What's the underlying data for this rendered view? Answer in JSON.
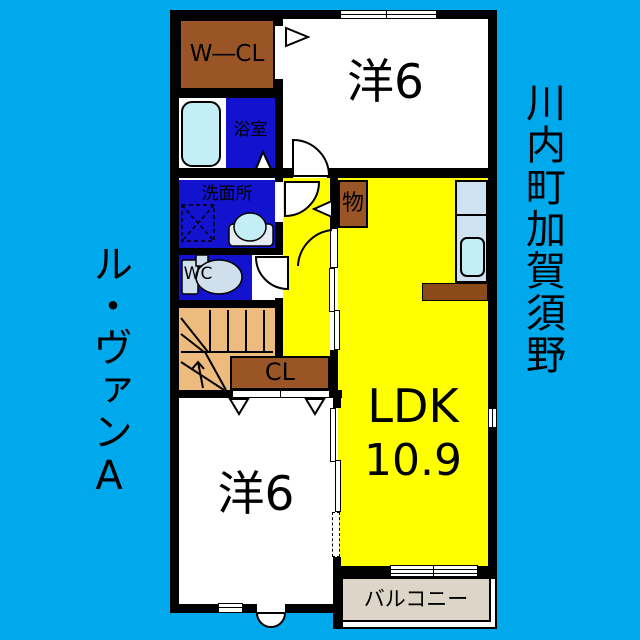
{
  "titles": {
    "left_vertical": "ル・ヴァンA",
    "right_vertical": "川内町加賀須野"
  },
  "rooms": {
    "wcl": {
      "label": "W―CL"
    },
    "bath": {
      "label": "浴室"
    },
    "washroom": {
      "label": "洗面所"
    },
    "wc": {
      "label": "WC"
    },
    "storage": {
      "label": "物"
    },
    "closet": {
      "label": "CL"
    },
    "western_top": {
      "label": "洋6"
    },
    "western_bottom": {
      "label": "洋6"
    },
    "ldk": {
      "label": "LDK",
      "size": "10.9"
    },
    "balcony": {
      "label": "バルコニー"
    }
  },
  "colors": {
    "background": "#00a8ec",
    "wall": "#000000",
    "room_blue": "#1212cf",
    "brown": "#9a5526",
    "counter_brown": "#8a4a1a",
    "yellow": "#ffff00",
    "stairs": "#edbb7d",
    "fixture": "#c4eef6",
    "fixture_gray": "#cfe0ec",
    "kitchen": "#cfe2f1",
    "balcony": "#ddd5c8"
  }
}
